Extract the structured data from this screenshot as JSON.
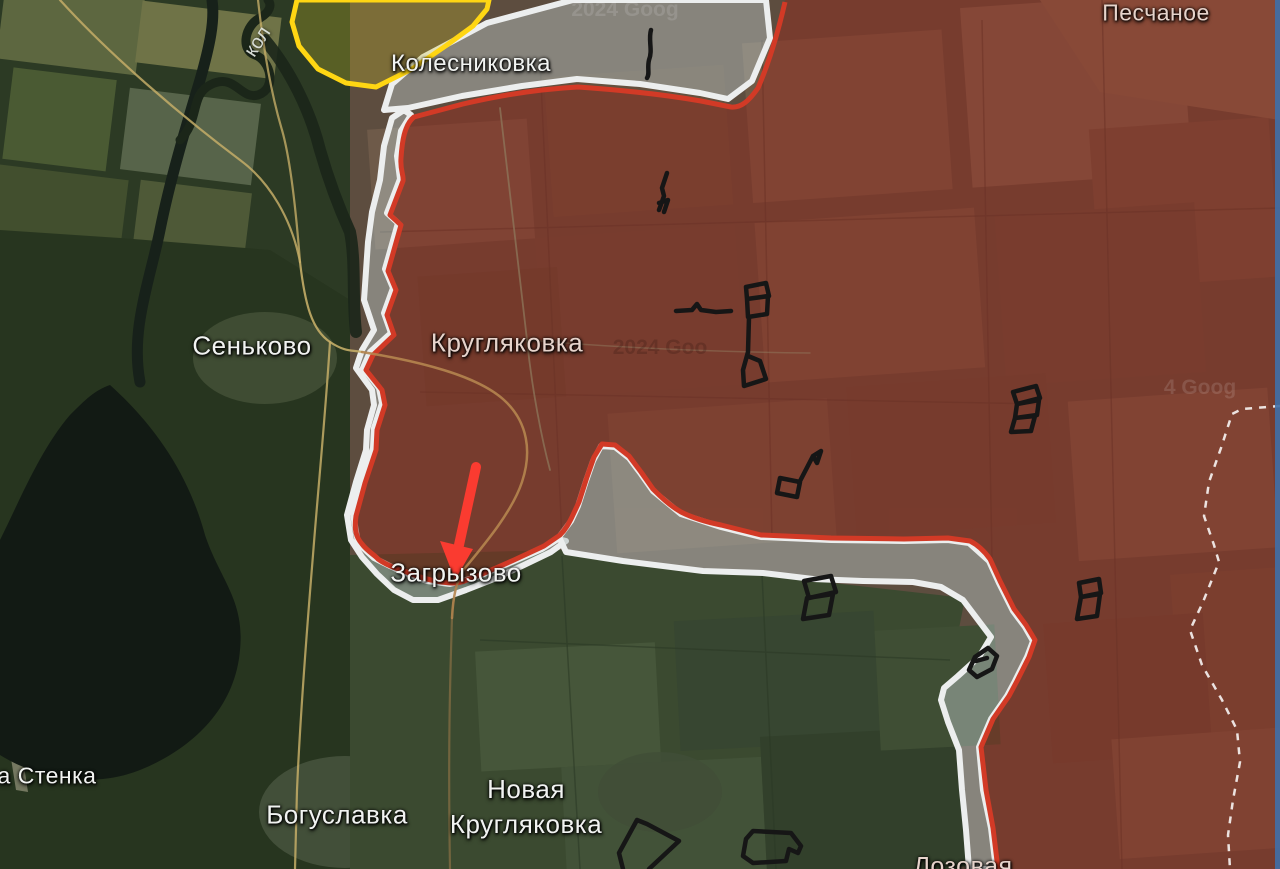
{
  "map": {
    "type": "frontline-situation-map",
    "colors": {
      "frontline_red": "#d23a26",
      "zone_outline_white": "#eceeee",
      "gray_zone_fill": "#b2bcba",
      "occupied_overlay": "#942a1e",
      "liberated_yellow": "#ffd613",
      "attack_arrow_red": "#fa3b30",
      "fortification_black": "#161616",
      "oblast_border_dash": "#ffffff",
      "road_yellow": "#c4ad67",
      "road_orange": "#b5854f",
      "water_dark": "#121a14"
    }
  },
  "labels": {
    "oskol_river": "кол",
    "kolesnikovka": "Колесниковка",
    "peschanoye": "Песчаное",
    "senkovo": "Сеньково",
    "kruhlyakovka": "Кругляковка",
    "zahryzove": "Загрызово",
    "stenka": "а Стенка",
    "bohuslavka": "Богуславка",
    "novaya_line1": "Новая",
    "novaya_line2": "Кругляковка",
    "lozovaya": "Лозовая"
  },
  "watermarks": {
    "top": "2024 Goog",
    "mid": "2024 Goo",
    "right": "4 Goog"
  }
}
